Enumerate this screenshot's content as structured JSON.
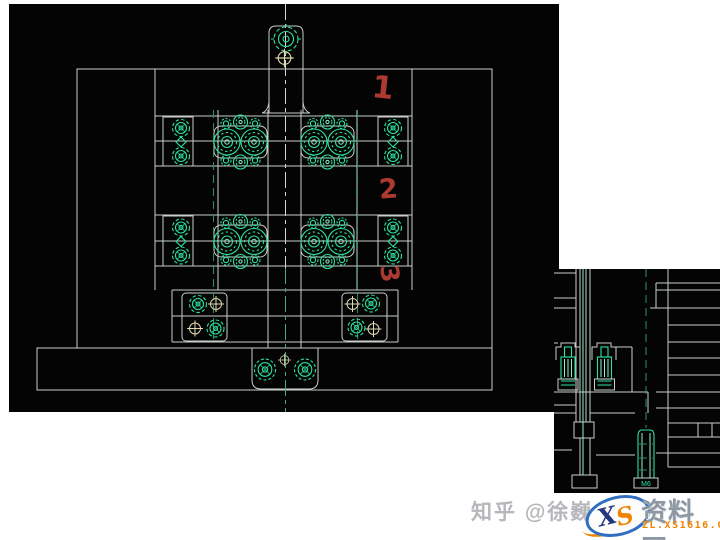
{
  "page": {
    "width": 720,
    "height": 540,
    "background": "#ffffff",
    "description": "CAD mold-base assembly drawing (plan view) with a section detail fragment at lower right, red handwritten step numbers, and a Zhihu watermark"
  },
  "colors": {
    "page_bg": "#ffffff",
    "cad_black": "#040404",
    "cad_line": "#c9cfc9",
    "cad_green": "#2ee09c",
    "green_bright": "#8df2cc",
    "green_dim": "#2f8f63",
    "pale_line": "#ded9b0",
    "annotation_red": "#ad3a31",
    "logo_blue": "#2f6fc1",
    "logo_navy": "#23357e",
    "logo_orange": "#f08300",
    "site_text_gray": "#8e98a4"
  },
  "annotations": {
    "items": [
      {
        "label": "1"
      },
      {
        "label": "2"
      },
      {
        "label": "3"
      }
    ]
  },
  "drawing": {
    "symbols": [
      "screw-target-icon",
      "round-nut-icon",
      "small-bolt-icon",
      "spoked-bolt-icon",
      "crosshair-hole-icon",
      "diamond-pin-icon",
      "socket-cap-screw-section-icon"
    ]
  },
  "section_view": {
    "bolt_label": "M6"
  },
  "watermark": {
    "text": "知乎 @徐巍"
  },
  "logo": {
    "letter_x": "X",
    "letter_s": "S",
    "site_name": "资料网",
    "site_url": "ZL.XS1616.COM"
  }
}
